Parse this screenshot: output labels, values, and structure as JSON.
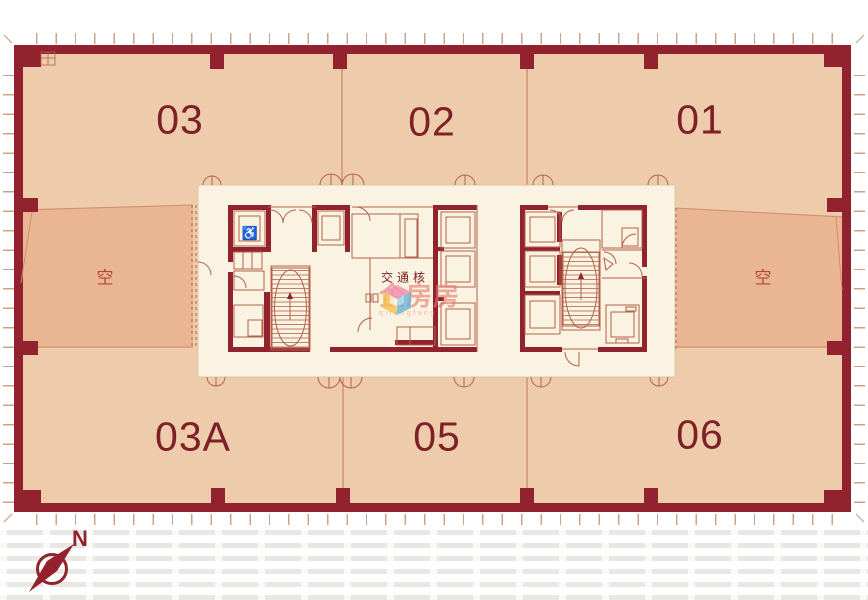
{
  "units": {
    "top": [
      {
        "label": "03"
      },
      {
        "label": "02"
      },
      {
        "label": "01"
      }
    ],
    "bottom": [
      {
        "label": "03A"
      },
      {
        "label": "05"
      },
      {
        "label": "06"
      }
    ]
  },
  "void_areas": {
    "left_label": "空",
    "right_label": "空"
  },
  "core": {
    "label": "交通核",
    "wheelchair_symbol": "♿"
  },
  "watermark": {
    "brand": "企房房",
    "subtext": "qifangfang"
  },
  "compass": {
    "north_label": "N"
  },
  "colors": {
    "wall": "#91222e",
    "unit_fill": "#eeccab",
    "void_fill": "#e9b593",
    "core_fill": "#faf3e2",
    "thin_line": "#b4604b",
    "unit_label": "#7d2027",
    "void_label": "#b54536",
    "compass": "#93222c",
    "ticks": "#cfa089",
    "watermark_pink": "#f28fae",
    "watermark_blue": "#6ab4d8",
    "watermark_yellow": "#f6c24e"
  }
}
